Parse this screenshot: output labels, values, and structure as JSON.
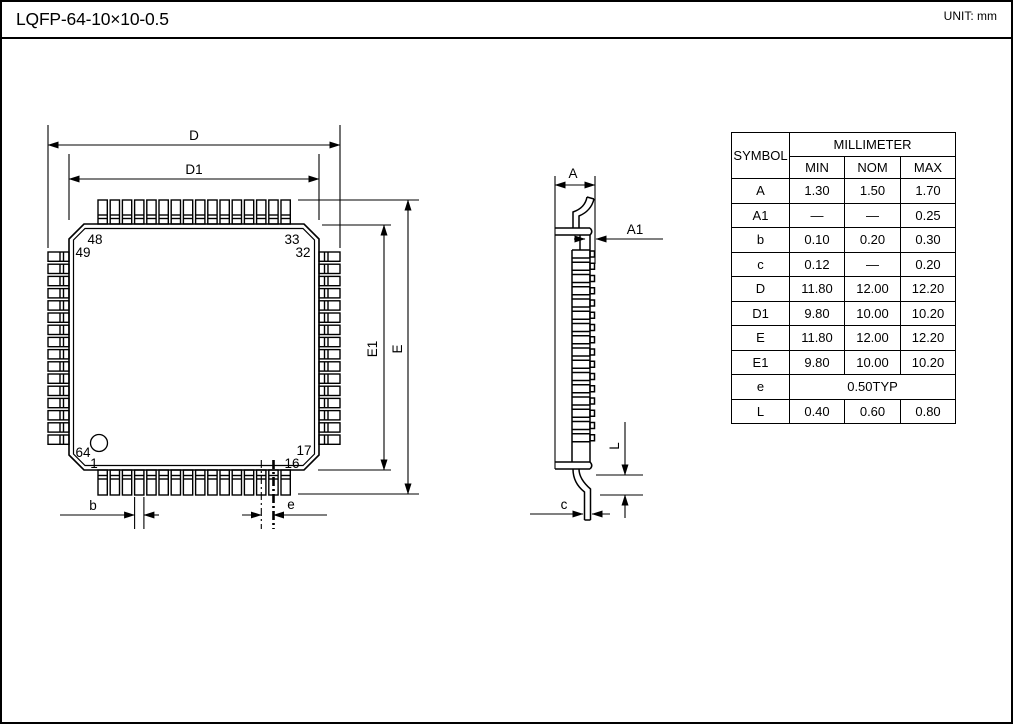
{
  "header": {
    "title": "LQFP-64-10×10-0.5",
    "unit": "UNIT: mm"
  },
  "top_view": {
    "dim_labels": {
      "D": "D",
      "D1": "D1",
      "E": "E",
      "E1": "E1",
      "b": "b",
      "e": "e"
    },
    "pin_labels": {
      "p48": "48",
      "p49": "49",
      "p33": "33",
      "p32": "32",
      "p64": "64",
      "p1": "1",
      "p17": "17",
      "p16": "16"
    },
    "pins_per_side": 16
  },
  "side_view": {
    "dim_labels": {
      "A": "A",
      "A1": "A1",
      "L": "L",
      "c": "c"
    }
  },
  "table": {
    "col_headers": {
      "symbol": "SYMBOL",
      "millimeter": "MILLIMETER",
      "min": "MIN",
      "nom": "NOM",
      "max": "MAX"
    },
    "rows": [
      {
        "symbol": "A",
        "min": "1.30",
        "nom": "1.50",
        "max": "1.70"
      },
      {
        "symbol": "A1",
        "min": "—",
        "nom": "—",
        "max": "0.25"
      },
      {
        "symbol": "b",
        "min": "0.10",
        "nom": "0.20",
        "max": "0.30"
      },
      {
        "symbol": "c",
        "min": "0.12",
        "nom": "—",
        "max": "0.20"
      },
      {
        "symbol": "D",
        "min": "11.80",
        "nom": "12.00",
        "max": "12.20"
      },
      {
        "symbol": "D1",
        "min": "9.80",
        "nom": "10.00",
        "max": "10.20"
      },
      {
        "symbol": "E",
        "min": "11.80",
        "nom": "12.00",
        "max": "12.20"
      },
      {
        "symbol": "E1",
        "min": "9.80",
        "nom": "10.00",
        "max": "10.20"
      },
      {
        "symbol": "e",
        "span": "0.50TYP"
      },
      {
        "symbol": "L",
        "min": "0.40",
        "nom": "0.60",
        "max": "0.80"
      }
    ]
  },
  "colors": {
    "ink": "#000000",
    "paper": "#ffffff"
  }
}
